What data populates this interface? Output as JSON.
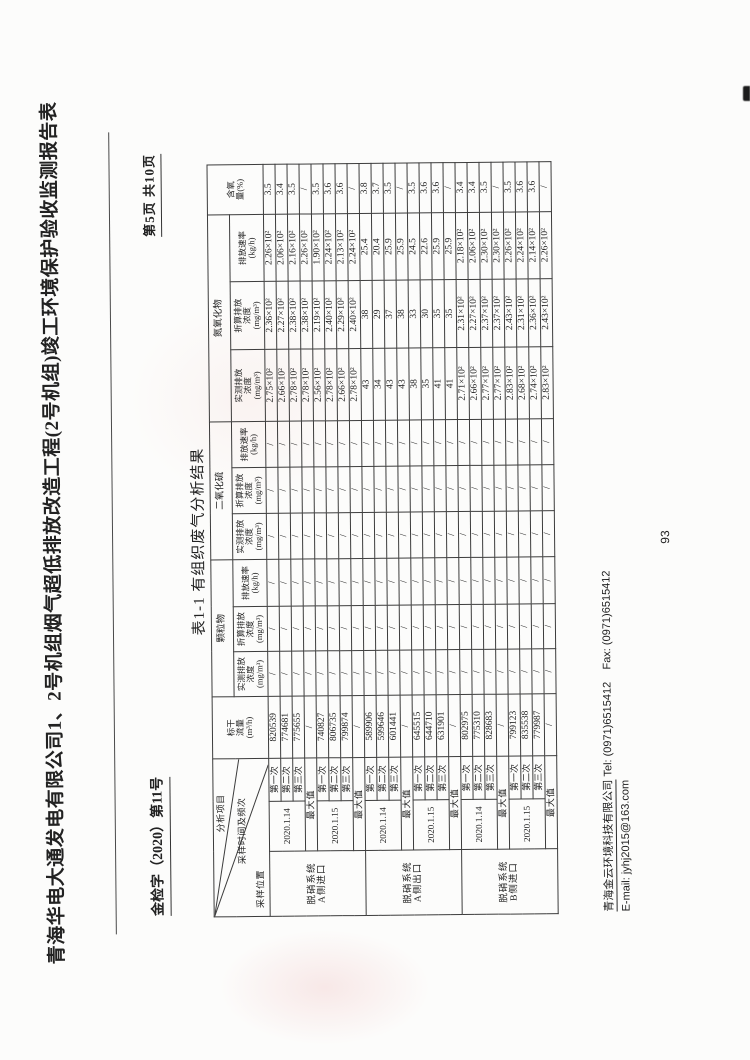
{
  "page_header": {
    "doc_title": "青海华电大通发电有限公司1、2号机组烟气超低排放改造工程(2号机组)竣工环境保护验收监测报告表",
    "doc_number": "金检字（2020）第11号",
    "page_indicator": "第5页 共10页"
  },
  "table": {
    "title": "表1-1 有组织废气分析结果",
    "diagonal": {
      "top": "分析项目",
      "middle": "采样时间及频次",
      "bottom": "采样位置"
    },
    "col_flow": "标干\n流量\n(m³/h)",
    "groups": [
      "颗粒物",
      "二氧化硫",
      "氮氧化物"
    ],
    "sub_measured": "实测排放\n浓度\n(mg/m³)",
    "sub_converted": "折算排放\n浓度\n(mg/m³)",
    "sub_rate": "排放速率\n(kg/h)",
    "col_oxygen": "含氧\n量(%)",
    "run_labels": [
      "第一次",
      "第二次",
      "第三次"
    ],
    "max_label": "最大值",
    "locations": [
      {
        "name": "脱硝系统\nA侧进口",
        "blocks": [
          {
            "date": "2020.1.14",
            "rows": [
              [
                "820539",
                "/",
                "/",
                "/",
                "/",
                "/",
                "/",
                "2.75×10²",
                "2.36×10²",
                "2.26×10²",
                "3.5"
              ],
              [
                "774681",
                "/",
                "/",
                "/",
                "/",
                "/",
                "/",
                "2.66×10²",
                "2.27×10²",
                "2.06×10²",
                "3.4"
              ],
              [
                "775655",
                "/",
                "/",
                "/",
                "/",
                "/",
                "/",
                "2.78×10²",
                "2.38×10²",
                "2.16×10²",
                "3.5"
              ]
            ],
            "max": [
              "/",
              "/",
              "/",
              "/",
              "/",
              "/",
              "/",
              "2.78×10²",
              "2.38×10²",
              "2.26×10²",
              "/"
            ]
          },
          {
            "date": "2020.1.15",
            "rows": [
              [
                "740827",
                "/",
                "/",
                "/",
                "/",
                "/",
                "/",
                "2.56×10²",
                "2.19×10²",
                "1.90×10²",
                "3.5"
              ],
              [
                "806735",
                "/",
                "/",
                "/",
                "/",
                "/",
                "/",
                "2.78×10²",
                "2.40×10²",
                "2.24×10²",
                "3.6"
              ],
              [
                "799874",
                "/",
                "/",
                "/",
                "/",
                "/",
                "/",
                "2.66×10²",
                "2.29×10²",
                "2.13×10²",
                "3.6"
              ]
            ],
            "max": [
              "/",
              "/",
              "/",
              "/",
              "/",
              "/",
              "/",
              "2.78×10²",
              "2.40×10²",
              "2.24×10²",
              "/"
            ]
          }
        ]
      },
      {
        "name": "脱硝系统\nA侧出口",
        "blocks": [
          {
            "date": "2020.1.14",
            "rows": [
              [
                "589906",
                "/",
                "/",
                "/",
                "/",
                "/",
                "/",
                "43",
                "38",
                "25.4",
                "3.8"
              ],
              [
                "599646",
                "/",
                "/",
                "/",
                "/",
                "/",
                "/",
                "34",
                "29",
                "20.4",
                "3.7"
              ],
              [
                "601441",
                "/",
                "/",
                "/",
                "/",
                "/",
                "/",
                "43",
                "37",
                "25.9",
                "3.5"
              ]
            ],
            "max": [
              "/",
              "/",
              "/",
              "/",
              "/",
              "/",
              "/",
              "43",
              "38",
              "25.9",
              "/"
            ]
          },
          {
            "date": "2020.1.15",
            "rows": [
              [
                "645515",
                "/",
                "/",
                "/",
                "/",
                "/",
                "/",
                "38",
                "33",
                "24.5",
                "3.5"
              ],
              [
                "644710",
                "/",
                "/",
                "/",
                "/",
                "/",
                "/",
                "35",
                "30",
                "22.6",
                "3.6"
              ],
              [
                "631901",
                "/",
                "/",
                "/",
                "/",
                "/",
                "/",
                "41",
                "35",
                "25.9",
                "3.6"
              ]
            ],
            "max": [
              "/",
              "/",
              "/",
              "/",
              "/",
              "/",
              "/",
              "41",
              "35",
              "25.9",
              "/"
            ]
          }
        ]
      },
      {
        "name": "脱硝系统\nB侧进口",
        "blocks": [
          {
            "date": "2020.1.14",
            "rows": [
              [
                "802975",
                "/",
                "/",
                "/",
                "/",
                "/",
                "/",
                "2.71×10²",
                "2.31×10²",
                "2.18×10²",
                "3.4"
              ],
              [
                "775310",
                "/",
                "/",
                "/",
                "/",
                "/",
                "/",
                "2.66×10²",
                "2.27×10²",
                "2.06×10²",
                "3.4"
              ],
              [
                "828683",
                "/",
                "/",
                "/",
                "/",
                "/",
                "/",
                "2.77×10²",
                "2.37×10²",
                "2.30×10²",
                "3.5"
              ]
            ],
            "max": [
              "/",
              "/",
              "/",
              "/",
              "/",
              "/",
              "/",
              "2.77×10²",
              "2.37×10²",
              "2.30×10²",
              "/"
            ]
          },
          {
            "date": "2020.1.15",
            "rows": [
              [
                "799123",
                "/",
                "/",
                "/",
                "/",
                "/",
                "/",
                "2.83×10²",
                "2.43×10²",
                "2.26×10²",
                "3.5"
              ],
              [
                "835538",
                "/",
                "/",
                "/",
                "/",
                "/",
                "/",
                "2.68×10²",
                "2.31×10²",
                "2.24×10²",
                "3.6"
              ],
              [
                "779987",
                "/",
                "/",
                "/",
                "/",
                "/",
                "/",
                "2.74×10²",
                "2.36×10²",
                "2.14×10²",
                "3.6"
              ]
            ],
            "max": [
              "/",
              "/",
              "/",
              "/",
              "/",
              "/",
              "/",
              "2.83×10²",
              "2.43×10²",
              "2.26×10²",
              "/"
            ]
          }
        ]
      }
    ]
  },
  "footer": {
    "company": "青海金云环境科技有限公司",
    "contact": " Tel: (0971)6515412    Fax: (0971)6515412",
    "email_line": "E-mail: jyhj2015@163.com",
    "sheet_page_number": "93"
  }
}
